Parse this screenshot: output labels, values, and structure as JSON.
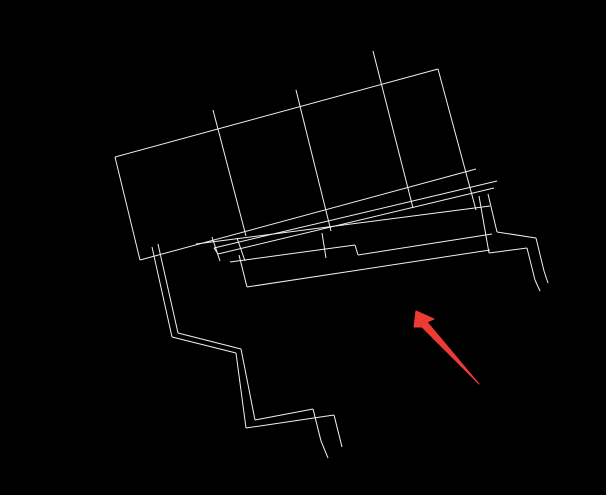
{
  "canvas": {
    "width": 606,
    "height": 495,
    "background": "#000000"
  },
  "drawing": {
    "description": "black-background CAD wireframe plan view, rotated about -15 degrees, with overlapping skewed outline copies, a long ledger band, and double-line stair zigzags at lower-left and right",
    "stroke_color": "#f0f0f0",
    "stroke_width": 1,
    "groups": [
      {
        "name": "main-rectangle-outline",
        "segments": [
          [
            115,
            157,
            438,
            69
          ],
          [
            115,
            157,
            140,
            260
          ],
          [
            438,
            69,
            476,
            210
          ],
          [
            140,
            260,
            476,
            169
          ]
        ]
      },
      {
        "name": "panel-divider-lines",
        "segments": [
          [
            213,
            110,
            246,
            236
          ],
          [
            296,
            90,
            331,
            231
          ],
          [
            373,
            51,
            413,
            208
          ]
        ]
      },
      {
        "name": "ledger-band-lines",
        "segments": [
          [
            214,
            248,
            497,
            181
          ],
          [
            218,
            254,
            494,
            188
          ],
          [
            214,
            248,
            218,
            254
          ],
          [
            212,
            237,
            220,
            261
          ],
          [
            237,
            238,
            245,
            261
          ],
          [
            322,
            233,
            326,
            258
          ],
          [
            196,
            244,
            490,
            206
          ],
          [
            230,
            262,
            355,
            245
          ],
          [
            355,
            245,
            358,
            255
          ],
          [
            358,
            255,
            492,
            234
          ],
          [
            247,
            287,
            490,
            250
          ],
          [
            239,
            255,
            247,
            287
          ]
        ]
      },
      {
        "name": "left-stair-steps",
        "segments": [
          [
            152,
            247,
            172,
            337
          ],
          [
            172,
            337,
            236,
            353
          ],
          [
            236,
            353,
            246,
            428
          ],
          [
            246,
            428,
            334,
            415
          ],
          [
            334,
            415,
            342,
            447
          ],
          [
            158,
            244,
            178,
            333
          ],
          [
            178,
            333,
            241,
            349
          ],
          [
            241,
            349,
            255,
            420
          ],
          [
            255,
            420,
            313,
            409
          ],
          [
            313,
            409,
            321,
            441
          ],
          [
            321,
            441,
            328,
            458
          ]
        ]
      },
      {
        "name": "right-stair-steps",
        "segments": [
          [
            488,
            194,
            497,
            232
          ],
          [
            497,
            232,
            536,
            238
          ],
          [
            536,
            238,
            544,
            271
          ],
          [
            544,
            271,
            548,
            283
          ],
          [
            479,
            196,
            489,
            253
          ],
          [
            489,
            253,
            527,
            248
          ],
          [
            527,
            248,
            535,
            280
          ],
          [
            535,
            280,
            540,
            291
          ]
        ]
      }
    ]
  },
  "annotation_arrow": {
    "name": "red-callout-arrow",
    "color": "#ee3a34",
    "tip": [
      416,
      311
    ],
    "tail": [
      479,
      384
    ],
    "polygon_points": [
      [
        416,
        311
      ],
      [
        434,
        319
      ],
      [
        427,
        322
      ],
      [
        479,
        384
      ],
      [
        422,
        327
      ],
      [
        414,
        327
      ]
    ]
  }
}
